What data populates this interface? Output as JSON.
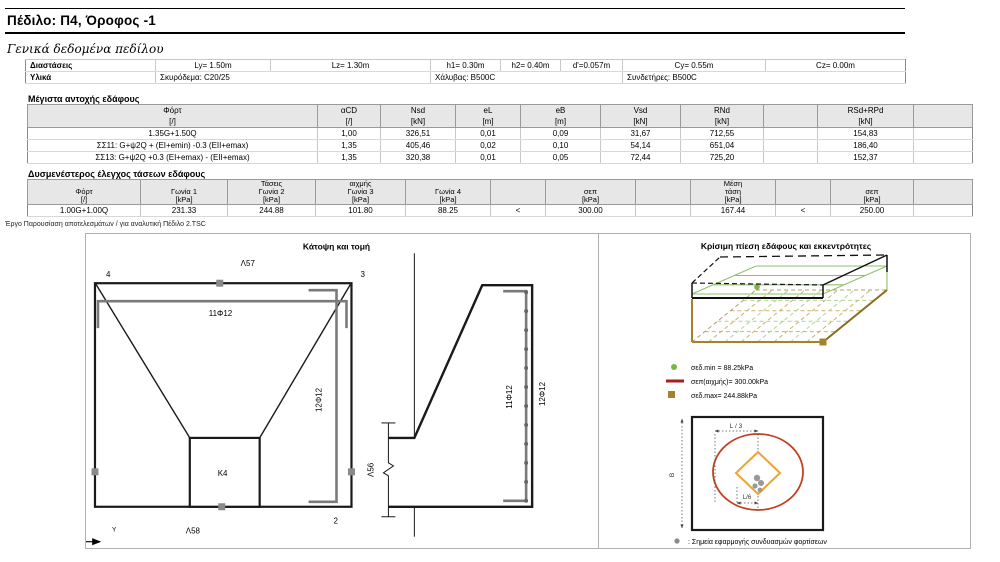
{
  "page": {
    "title": "Πέδιλο: Π4, Όροφος -1",
    "project_note": "Έργο Παρουσίαση αποτελεσμάτων / για αναλυτική Πέδιλο 2.TSC"
  },
  "general": {
    "heading": "Γενικά δεδομένα πεδίλου",
    "dimensions_label": "Διαστάσεις",
    "materials_label": "Υλικά",
    "dims": [
      "Ly= 1.50m",
      "Lz= 1.30m",
      "h1= 0.30m",
      "h2= 0.40m",
      "d'=0.057m",
      "Cy= 0.55m",
      "Cz= 0.00m"
    ],
    "materials": [
      "Σκυρόδεμα: C20/25",
      "Χάλυβας: B500C",
      "Συνδετήρες: B500C"
    ]
  },
  "max_table": {
    "heading": "Μέγιστα αντοχής εδάφους",
    "headers": {
      "fort": "Φόρτ",
      "acd": "αCD",
      "nsd": "Nsd",
      "el": "eL",
      "eb": "eB",
      "vsd": "Vsd",
      "rnd": "RNd",
      "rsd": "RSd+RPd"
    },
    "units": {
      "fort": "[/]",
      "acd": "[/]",
      "nsd": "[kN]",
      "el": "[m]",
      "eb": "[m]",
      "vsd": "[kN]",
      "rnd": "[kN]",
      "rsd": "[kN]"
    },
    "rows": [
      {
        "fort": "1.35G+1.50Q",
        "acd": "1,00",
        "nsd": "326,51",
        "el": "0,01",
        "eb": "0,09",
        "vsd": "31,67",
        "rnd": "712,55",
        "rsd": "154,83"
      },
      {
        "fort": "ΣΣ11: G+ψ2Q + (EI+emin) -0.3 (EII+emax)",
        "acd": "1,35",
        "nsd": "405,46",
        "el": "0,02",
        "eb": "0,10",
        "vsd": "54,14",
        "rnd": "651,04",
        "rsd": "186,40"
      },
      {
        "fort": "ΣΣ13: G+ψ2Q +0.3 (EI+emax) - (EII+emax)",
        "acd": "1,35",
        "nsd": "320,38",
        "el": "0,01",
        "eb": "0,05",
        "vsd": "72,44",
        "rnd": "725,20",
        "rsd": "152,37"
      }
    ]
  },
  "stress_table": {
    "heading": "Δυσμενέστερος έλεγχος τάσεων εδάφους",
    "group_labels": {
      "g2": "Τάσεις",
      "g3": "αιχμής",
      "mean": "Μέση"
    },
    "headers": {
      "fort": "Φόρτ",
      "g1": "Γωνία 1",
      "g2": "Γωνία 2",
      "g3": "Γωνία 3",
      "g4": "Γωνία 4",
      "sep1": "σεπ",
      "mean": "τάση",
      "sep2": "σεπ"
    },
    "units": {
      "fort": "[/]",
      "g1": "[kPa]",
      "g2": "[kPa]",
      "g3": "[kPa]",
      "g4": "[kPa]",
      "sep1": "[kPa]",
      "mean": "[kPa]",
      "sep2": "[kPa]"
    },
    "row": {
      "fort": "1.00G+1.00Q",
      "g1": "231.33",
      "g2": "244.88",
      "g3": "101.80",
      "g4": "88.25",
      "lt1": "<",
      "sep1": "300.00",
      "mean": "167.44",
      "lt2": "<",
      "sep2": "250.00"
    }
  },
  "plan_panel": {
    "title": "Κάτοψη και τομή",
    "labels": {
      "top_bar": "Λ57",
      "bottom_bar": "Λ58",
      "left_bar": "Λ64",
      "section_bar": "Λ56",
      "plan_bars_y": "11Φ12",
      "plan_bars_z": "12Φ12",
      "section_bars_y": "11Φ12",
      "section_bars_z": "12Φ12",
      "column": "K4",
      "corner1": "1",
      "corner2": "2",
      "corner3": "3",
      "corner4": "4",
      "axis_y": "Y",
      "axis_z": "z"
    }
  },
  "pressure_panel": {
    "title": "Κρίσιμη πίεση εδάφους και εκκεντρότητες",
    "legend": {
      "min": "σεδ.min = 88.25kPa",
      "peak": "σεπ(αιχμής)= 300.00kPa",
      "max": "σεδ.max= 244.88kPa"
    },
    "diagram": {
      "dim_l3": "L / 3",
      "dim_l6": "L/6",
      "dim_b": "B",
      "note": ": Σημεία εφαρμογής συνδυασμών φορτίσεων"
    }
  },
  "colors": {
    "header_bg": "#e7e7e7",
    "green": "#7cb347",
    "olive": "#a5812d",
    "dark_red": "#a32020",
    "ellipse_red": "#c2401f",
    "orange": "#f0a232",
    "gray": "#8a8a8a"
  }
}
